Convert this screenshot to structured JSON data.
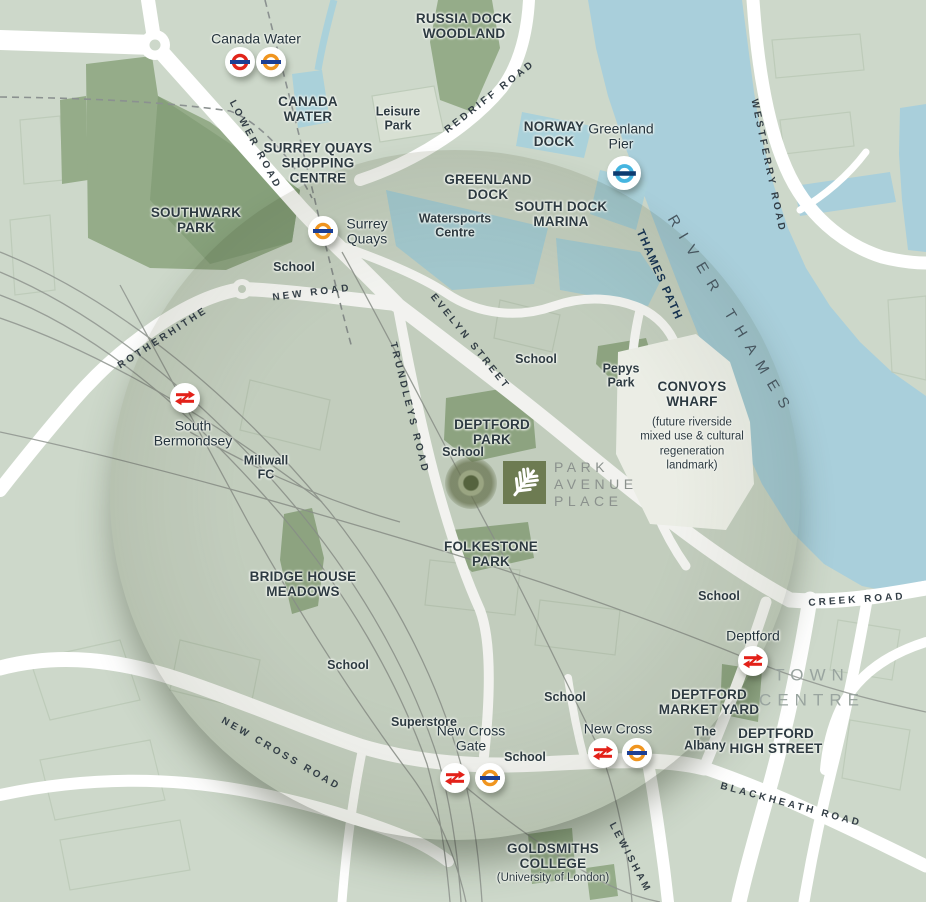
{
  "logo": {
    "lines": [
      "PARK",
      "AVENUE",
      "PLACE"
    ]
  },
  "colors": {
    "land": "#cdd8ca",
    "water": "#a9cfdb",
    "park_green": "#95ac89",
    "road_white": "#ffffff",
    "logo_olive": "#6d7b52",
    "label_dark": "#2d3a41",
    "underground_red": "#e1251b",
    "overground_orange": "#f0951f",
    "roundel_bar_navy": "#1c3f94",
    "pier_blue": "#45b5e0",
    "rail_red": "#e32119",
    "town_centre_gray": "#99a49f",
    "river_label_gray": "#47565f",
    "thames_path_navy": "#16324f"
  },
  "map": {
    "labels": [
      {
        "name": "russia-dock-woodland",
        "type": "area",
        "text": "RUSSIA DOCK\nWOODLAND",
        "x": 464,
        "y": 26
      },
      {
        "name": "canada-water-area",
        "type": "area",
        "text": "CANADA\nWATER",
        "x": 308,
        "y": 109
      },
      {
        "name": "surrey-quays-shopping-centre",
        "type": "area",
        "text": "SURREY QUAYS\nSHOPPING\nCENTRE",
        "x": 318,
        "y": 163
      },
      {
        "name": "norway-dock",
        "type": "area",
        "text": "NORWAY\nDOCK",
        "x": 554,
        "y": 134
      },
      {
        "name": "greenland-dock",
        "type": "area",
        "text": "GREENLAND\nDOCK",
        "x": 488,
        "y": 187
      },
      {
        "name": "south-dock-marina",
        "type": "area",
        "text": "SOUTH DOCK\nMARINA",
        "x": 561,
        "y": 214
      },
      {
        "name": "southwark-park",
        "type": "area",
        "text": "SOUTHWARK\nPARK",
        "x": 196,
        "y": 220
      },
      {
        "name": "convoys-wharf",
        "type": "area",
        "text": "CONVOYS\nWHARF",
        "x": 692,
        "y": 394
      },
      {
        "name": "convoys-wharf-note",
        "type": "note",
        "text": "(future riverside\nmixed use & cultural\nregeneration\nlandmark)",
        "x": 692,
        "y": 444
      },
      {
        "name": "deptford-park",
        "type": "area",
        "text": "DEPTFORD\nPARK",
        "x": 492,
        "y": 432
      },
      {
        "name": "folkestone-park",
        "type": "area",
        "text": "FOLKESTONE\nPARK",
        "x": 491,
        "y": 554
      },
      {
        "name": "bridge-house-meadows",
        "type": "area",
        "text": "BRIDGE HOUSE\nMEADOWS",
        "x": 303,
        "y": 584
      },
      {
        "name": "deptford-market-yard",
        "type": "area",
        "text": "DEPTFORD\nMARKET YARD",
        "x": 709,
        "y": 702
      },
      {
        "name": "deptford-high-street",
        "type": "area",
        "text": "DEPTFORD\nHIGH STREET",
        "x": 776,
        "y": 741
      },
      {
        "name": "goldsmiths-college",
        "type": "area",
        "text": "GOLDSMITHS\nCOLLEGE",
        "x": 553,
        "y": 856
      },
      {
        "name": "goldsmiths-note",
        "type": "note",
        "text": "(University of London)",
        "x": 553,
        "y": 878
      },
      {
        "name": "leisure-park",
        "type": "place",
        "text": "Leisure\nPark",
        "x": 398,
        "y": 119
      },
      {
        "name": "watersports-centre",
        "type": "place",
        "text": "Watersports\nCentre",
        "x": 455,
        "y": 226
      },
      {
        "name": "school-surrey-quays",
        "type": "place",
        "text": "School",
        "x": 294,
        "y": 268
      },
      {
        "name": "school-evelyn",
        "type": "place",
        "text": "School",
        "x": 536,
        "y": 360
      },
      {
        "name": "pepys-park",
        "type": "place",
        "text": "Pepys\nPark",
        "x": 621,
        "y": 376
      },
      {
        "name": "millwall-fc",
        "type": "place",
        "text": "Millwall\nFC",
        "x": 266,
        "y": 468
      },
      {
        "name": "school-deptford-park",
        "type": "place",
        "text": "School",
        "x": 463,
        "y": 453
      },
      {
        "name": "school-creek",
        "type": "place",
        "text": "School",
        "x": 719,
        "y": 597
      },
      {
        "name": "school-bridge-house",
        "type": "place",
        "text": "School",
        "x": 348,
        "y": 666
      },
      {
        "name": "school-new-cross-north",
        "type": "place",
        "text": "School",
        "x": 565,
        "y": 698
      },
      {
        "name": "superstore",
        "type": "place",
        "text": "Superstore",
        "x": 424,
        "y": 723
      },
      {
        "name": "school-new-cross",
        "type": "place",
        "text": "School",
        "x": 525,
        "y": 758
      },
      {
        "name": "the-albany",
        "type": "place",
        "text": "The\nAlbany",
        "x": 705,
        "y": 739
      },
      {
        "name": "canada-water-station-label",
        "type": "station",
        "text": "Canada Water",
        "x": 256,
        "y": 39
      },
      {
        "name": "surrey-quays-station-label",
        "type": "station",
        "text": "Surrey\nQuays",
        "x": 367,
        "y": 232
      },
      {
        "name": "greenland-pier-label",
        "type": "station",
        "text": "Greenland\nPier",
        "x": 621,
        "y": 137
      },
      {
        "name": "south-bermondsey-station-label",
        "type": "station",
        "text": "South\nBermondsey",
        "x": 193,
        "y": 434
      },
      {
        "name": "deptford-station-label",
        "type": "station",
        "text": "Deptford",
        "x": 753,
        "y": 636
      },
      {
        "name": "new-cross-gate-station-label",
        "type": "station",
        "text": "New Cross\nGate",
        "x": 471,
        "y": 739
      },
      {
        "name": "new-cross-station-label",
        "type": "station",
        "text": "New Cross",
        "x": 618,
        "y": 729
      },
      {
        "name": "lower-road",
        "type": "road",
        "text": "LOWER ROAD",
        "x": 255,
        "y": 145,
        "rot": 62
      },
      {
        "name": "redriff-road",
        "type": "road",
        "text": "REDRIFF ROAD",
        "x": 490,
        "y": 97,
        "rot": -38
      },
      {
        "name": "westferry-road",
        "type": "road",
        "text": "WESTFERRY ROAD",
        "x": 768,
        "y": 166,
        "rot": 78
      },
      {
        "name": "rotherhithe",
        "type": "road",
        "text": "ROTHERHITHE",
        "x": 163,
        "y": 338,
        "rot": -33
      },
      {
        "name": "new-road",
        "type": "road",
        "text": "NEW ROAD",
        "x": 312,
        "y": 293,
        "rot": -7
      },
      {
        "name": "evelyn-street",
        "type": "road",
        "text": "EVELYN STREET",
        "x": 470,
        "y": 342,
        "rot": 51
      },
      {
        "name": "trundleys-road",
        "type": "road",
        "text": "TRUNDLEYS ROAD",
        "x": 409,
        "y": 408,
        "rot": 76
      },
      {
        "name": "creek-road",
        "type": "road",
        "text": "CREEK ROAD",
        "x": 857,
        "y": 600,
        "rot": -4
      },
      {
        "name": "new-cross-road",
        "type": "road",
        "text": "NEW CROSS ROAD",
        "x": 281,
        "y": 754,
        "rot": 30
      },
      {
        "name": "blackheath-road",
        "type": "road",
        "text": "BLACKHEATH ROAD",
        "x": 791,
        "y": 805,
        "rot": 15
      },
      {
        "name": "lewisham",
        "type": "road",
        "text": "LEWISHAM",
        "x": 630,
        "y": 858,
        "rot": 62
      },
      {
        "name": "thames-path",
        "type": "thamespath",
        "text": "THAMES PATH",
        "x": 659,
        "y": 275,
        "rot": 66
      },
      {
        "name": "river-thames",
        "type": "river",
        "text": "RIVER THAMES",
        "x": 731,
        "y": 316,
        "rot": 59
      },
      {
        "name": "town-centre",
        "type": "towncentre",
        "text": "TOWN\nCENTRE",
        "x": 812,
        "y": 688
      }
    ],
    "badges": [
      {
        "station": "Canada Water",
        "type": "underground",
        "x": 240,
        "y": 62
      },
      {
        "station": "Canada Water",
        "type": "overground",
        "x": 271,
        "y": 62
      },
      {
        "station": "Surrey Quays",
        "type": "overground",
        "x": 323,
        "y": 231
      },
      {
        "station": "Greenland Pier",
        "type": "pier",
        "x": 624,
        "y": 173
      },
      {
        "station": "South Bermondsey",
        "type": "rail",
        "x": 185,
        "y": 398
      },
      {
        "station": "Deptford",
        "type": "rail",
        "x": 753,
        "y": 661
      },
      {
        "station": "New Cross Gate",
        "type": "rail",
        "x": 455,
        "y": 778
      },
      {
        "station": "New Cross Gate",
        "type": "overground",
        "x": 490,
        "y": 778
      },
      {
        "station": "New Cross",
        "type": "rail",
        "x": 603,
        "y": 753
      },
      {
        "station": "New Cross",
        "type": "overground",
        "x": 637,
        "y": 753
      }
    ]
  }
}
